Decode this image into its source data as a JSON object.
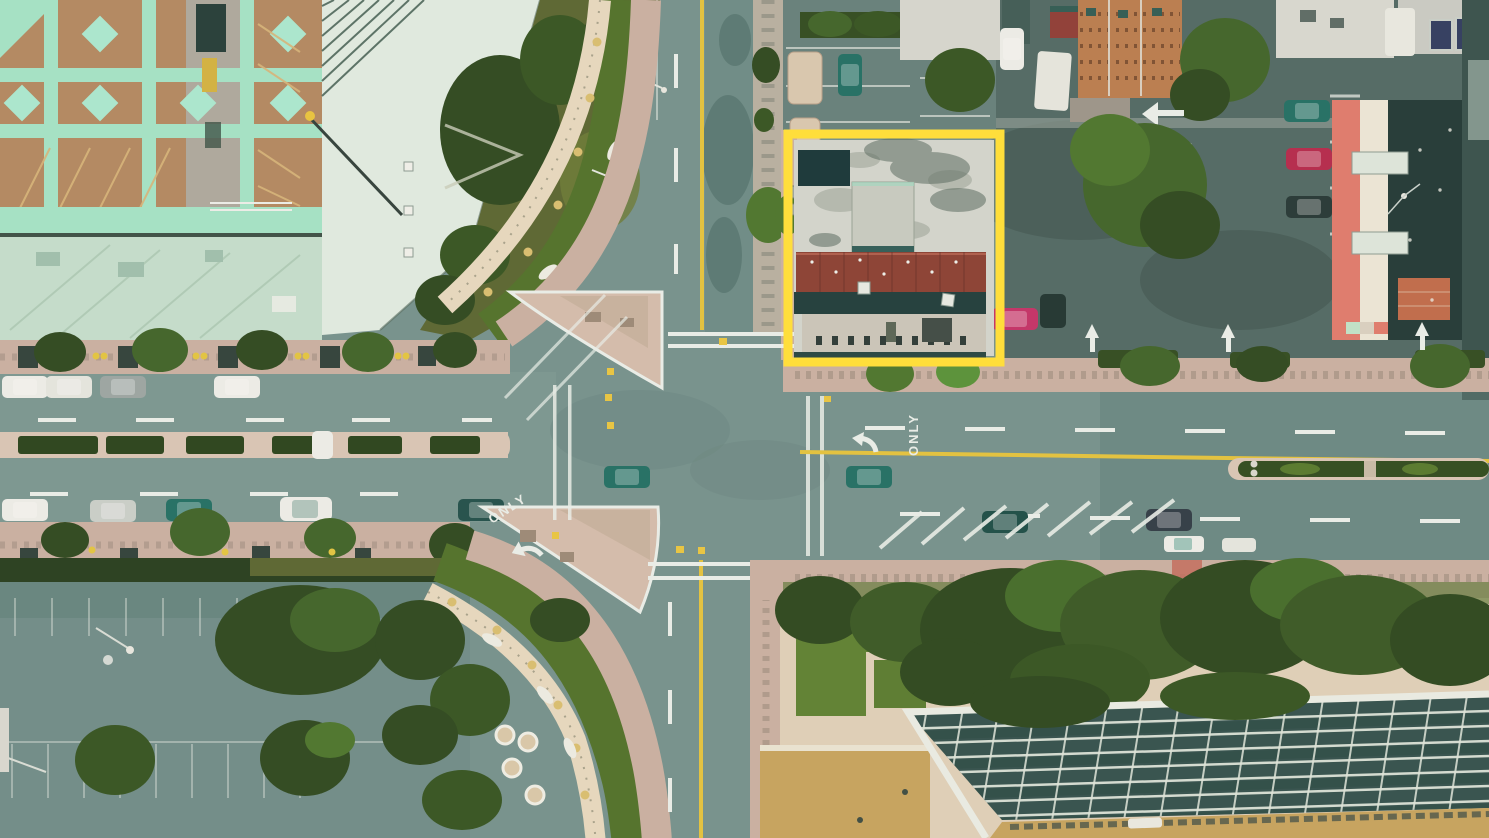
{
  "scene": {
    "type": "aerial-photograph",
    "view": "Top-down drone view of a four-way city intersection with a yellow box highlighting one building block",
    "style": "teal-and-pink faded film tint"
  },
  "annotations": {
    "highlight_box": {
      "x": 788,
      "y": 134,
      "width": 212,
      "height": 228,
      "color": "#FFDE3B",
      "thickness_px": 9,
      "purpose": "highlights a flat-roofed commercial building block"
    }
  },
  "road_markings": {
    "west_only_label": "ONLY",
    "east_only_label": "ONLY"
  },
  "features": {
    "top_left": "parking-garage rooftop with tan deck, mint grid bands and mint diamond markings",
    "upper_left_center": "pale office roof, olive garden with curved cream pergola walkway",
    "top_right": "dark retail parking lot with parked cars, trees and rooftop row; salmon-and-dark apartment building at far right",
    "bottom_left": "large empty teal parking lot with faint stall lines, trees and light poles",
    "bottom_right": "landscaped plaza with dense trees and a large glass atrium roof with white grid",
    "intersection": "signalized four-way intersection with two channelized pink corner islands",
    "parked_cars_left_street": 9,
    "moving_cars_visible": 7,
    "median_planters_left_street": 6
  },
  "palette": {
    "asphalt": "#73918C",
    "asphalt_dark": "#5E7D78",
    "lot_dark": "#4E6862",
    "lot_light": "#6E8C87",
    "sidewalk_pink": "#C9AFA1",
    "sidewalk_light": "#D9C6B5",
    "island_pink": "#D3BCAB",
    "pergola_cream": "#E6D8BE",
    "plaza_cream": "#DFD0B8",
    "grass_bright": "#5F8430",
    "lawn_olive": "#58652F",
    "hedge_dark": "#2F4A1E",
    "tree_dark": "#2C471D",
    "tree_mid": "#3E6326",
    "tree_bright": "#569136",
    "deck_tan": "#B1875F",
    "deck_mint": "#A3E3C6",
    "roof_seafoam": "#C3DECC",
    "roof_pale": "#E0EBE1",
    "marking_white": "#E9EFE9",
    "lane_yellow": "#E3C23C",
    "highlight_yellow": "#FFDE3B",
    "roof_white_mottled": "#D3D4CB",
    "roof_red": "#8E4537",
    "band_dark": "#27423F",
    "bldg_salmon": "#DF7A6B",
    "bldg_cream": "#E9E3D2",
    "roof_dark": "#1F3734",
    "brick_orange": "#BF6A48",
    "glass_teal": "#31504B",
    "glass_grid": "#DDE5DA",
    "roof_khaki": "#C6A35C",
    "car_white": "#EDEEE8",
    "car_teal": "#1F6E63",
    "car_red": "#B4274A",
    "car_pink": "#C23066",
    "car_dark": "#233634"
  }
}
